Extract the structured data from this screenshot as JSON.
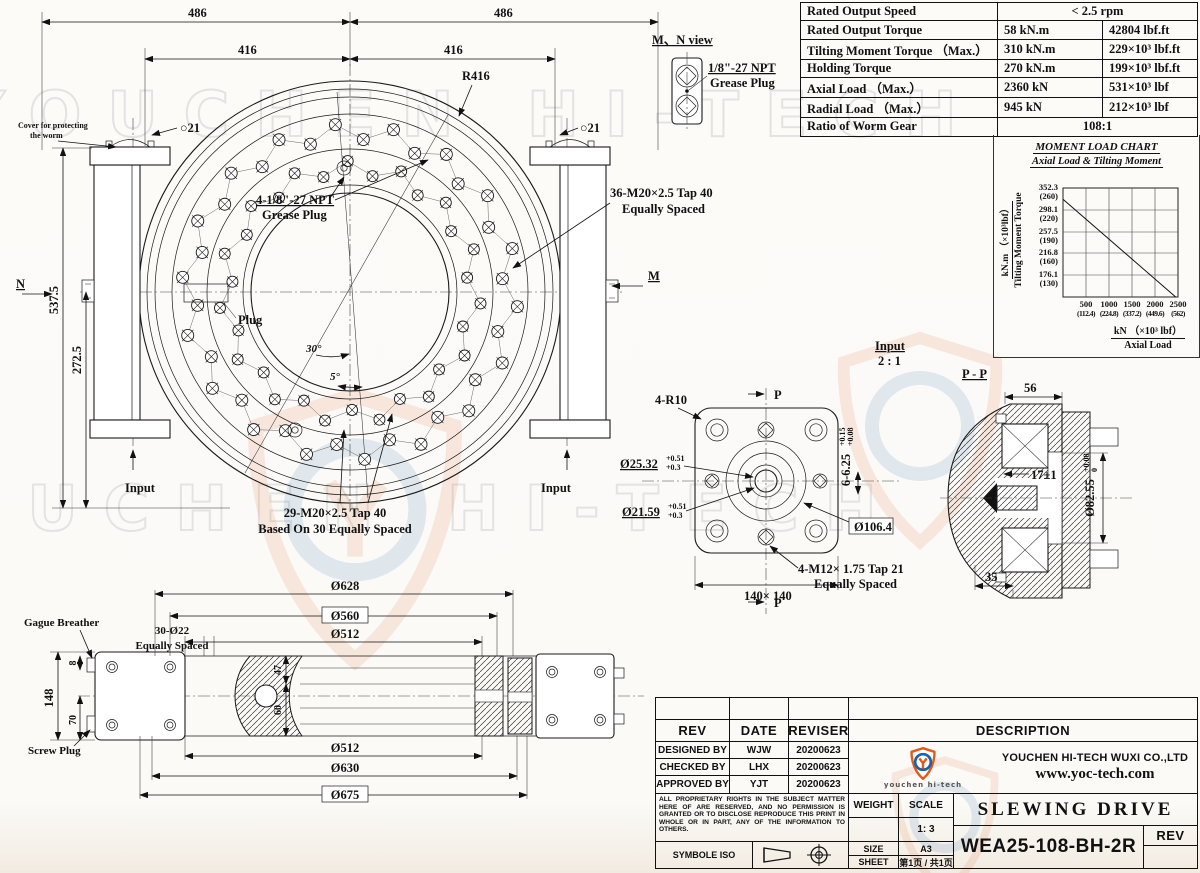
{
  "watermark": {
    "text": "YOUCHEN HI-TECH"
  },
  "spec_table": {
    "rows": [
      {
        "label": "Rated Output Speed",
        "value": "< 2.5 rpm",
        "value2": ""
      },
      {
        "label": "Rated Output Torque",
        "value": "58 kN.m",
        "value2": "42804 lbf.ft"
      },
      {
        "label": "Tilting Moment Torque （Max.）",
        "value": "310 kN.m",
        "value2": "229×10³ lbf.ft"
      },
      {
        "label": "Holding Torque",
        "value": "270 kN.m",
        "value2": "199×10³ lbf.ft"
      },
      {
        "label": "Axial Load （Max.）",
        "value": "2360 kN",
        "value2": "531×10³ lbf"
      },
      {
        "label": "Radial Load （Max.）",
        "value": "945 kN",
        "value2": "212×10³ lbf"
      },
      {
        "label": "Ratio of Worm Gear",
        "value": "108:1",
        "value2": ""
      }
    ]
  },
  "chart_data": {
    "type": "line",
    "title": "MOMENT LOAD CHART",
    "subtitle": "Axial Load & Tilting Moment",
    "ylabel_unit": "kN.m （×10³lbf）",
    "ylabel": "Tilting Moment Torque",
    "xlabel_unit": "kN （×10³ lbf）",
    "xlabel": "Axial Load",
    "y_ticks": [
      {
        "knm": "352.3",
        "lbf": "(260)"
      },
      {
        "knm": "298.1",
        "lbf": "(220)"
      },
      {
        "knm": "257.5",
        "lbf": "(190)"
      },
      {
        "knm": "216.8",
        "lbf": "(160)"
      },
      {
        "knm": "176.1",
        "lbf": "(130)"
      }
    ],
    "x_ticks": [
      {
        "kn": "500",
        "lbf": "(112.4)"
      },
      {
        "kn": "1000",
        "lbf": "(224.8)"
      },
      {
        "kn": "1500",
        "lbf": "(337.2)"
      },
      {
        "kn": "2000",
        "lbf": "(449.6)"
      },
      {
        "kn": "2500",
        "lbf": "(562)"
      }
    ],
    "xlim": [
      0,
      2500
    ],
    "ylim": [
      135,
      352.3
    ],
    "grid": true,
    "legend": "none",
    "series": [
      {
        "name": "allowable axial load vs tilting moment",
        "points": [
          [
            0,
            330
          ],
          [
            2450,
            135
          ]
        ]
      }
    ]
  },
  "top_view": {
    "dim_486_left": "486",
    "dim_486_right": "486",
    "dim_416_left": "416",
    "dim_416_right": "416",
    "radius": "R416",
    "hole_left": "○21",
    "hole_right": "○21",
    "cover_line1": "Cover for protecting",
    "cover_line2": "the worm",
    "n_label": "N",
    "m_label": "M",
    "dim_537": "537.5",
    "dim_272": "272.5",
    "grease_line1": "4-1/8\"-27 NPT",
    "grease_line2": "Grease Plug",
    "tap36_line1": "36-M20×2.5 Tap 40",
    "tap36_line2": "Equally Spaced",
    "plug_label": "Plug",
    "angle_30": "30°",
    "angle_5": "5°",
    "input_left": "Input",
    "input_right": "Input",
    "tap29_line1": "29-M20×2.5 Tap 40",
    "tap29_line2": "Based On 30 Equally Spaced",
    "bolts_outer": 36,
    "bolts_inner": 30
  },
  "mn_view": {
    "title": "M、N view",
    "plug_line1": "1/8\"-27 NPT",
    "plug_line2": "Grease Plug"
  },
  "input_view": {
    "title": "Input",
    "scale": "2 : 1",
    "corner": "4-R10",
    "section": "P",
    "bore_large": "Ø25.32",
    "bore_large_tol_upper": "+0.51",
    "bore_large_tol_lower": "+0.3",
    "bore_small": "Ø21.59",
    "bore_small_tol_upper": "+0.51",
    "bore_small_tol_lower": "+0.3",
    "key_slot": "6-6.25",
    "key_slot_tol_upper": "+0.15",
    "key_slot_tol_lower": "+0.08",
    "pilot": "Ø106.4",
    "tap_line1": "4-M12× 1.75 Tap 21",
    "tap_line2": "Equally Spaced",
    "square": "140× 140"
  },
  "pp_view": {
    "title": "P - P",
    "dim_56": "56",
    "dim_17": "17±1",
    "dim_82": "Ø82.55",
    "dim_82_tol_upper": "+0.08",
    "dim_82_tol_lower": "0",
    "dim_35": "35"
  },
  "side_view": {
    "gauge_label": "Gague Breather",
    "screw_label": "Screw Plug",
    "dim_148": "148",
    "dim_8": "8",
    "dim_70": "70",
    "holes_line1": "30-Ø22",
    "holes_line2": "Equally Spaced",
    "dim_628": "Ø628",
    "dim_560": "Ø560",
    "dim_512_top": "Ø512",
    "dim_47": "47",
    "dim_60": "60",
    "dim_512_bottom": "Ø512",
    "dim_630": "Ø630",
    "dim_675": "Ø675"
  },
  "title_block": {
    "rev": "REV",
    "date": "DATE",
    "reviser": "REVISER",
    "description": "DESCRIPTION",
    "designed_by": "DESIGNED BY",
    "designed_name": "WJW",
    "designed_date": "20200623",
    "checked_by": "CHECKED BY",
    "checked_name": "LHX",
    "checked_date": "20200623",
    "approved_by": "APPROVED BY",
    "approved_name": "YJT",
    "approved_date": "20200623",
    "company": "YOUCHEN HI-TECH WUXI CO.,LTD",
    "website": "www.yoc-tech.com",
    "logo_wordmark": "youchen hi-tech",
    "proprietary": "ALL PROPRIETARY RIGHTS IN THE SUBJECT MATTER HERE OF ARE RESERVED, AND NO PERMISSION IS GRANTED OR TO DISCLOSE REPRODUCE THIS PRINT IN WHOLE OR IN PART, ANY OF THE INFORMATION TO OTHERS.",
    "symbole": "SYMBOLE ISO",
    "weight": "WEIGHT",
    "scale": "SCALE",
    "scale_value": "1: 3",
    "size": "SIZE",
    "size_value": "A3",
    "sheet": "SHEET",
    "sheet_value": "第1页 / 共1页",
    "product": "SLEWING DRIVE",
    "model": "WEA25-108-BH-2R",
    "rev_label": "REV"
  }
}
